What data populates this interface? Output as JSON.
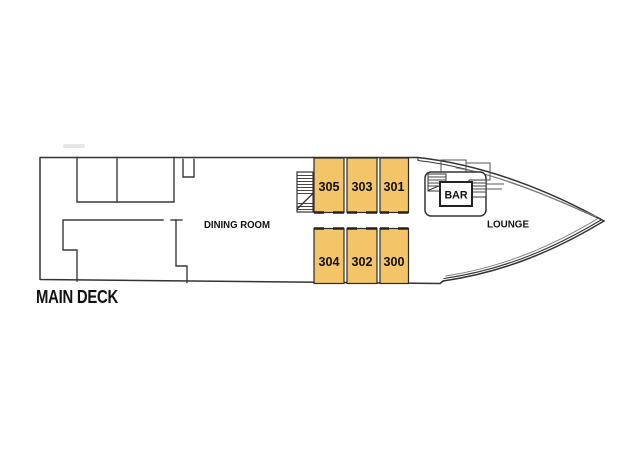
{
  "deck": {
    "title": "MAIN DECK"
  },
  "areas": {
    "dining_room": "DINING ROOM",
    "lounge": "LOUNGE",
    "bar": "BAR"
  },
  "cabins": {
    "top_row": [
      "305",
      "303",
      "301"
    ],
    "bottom_row": [
      "304",
      "302",
      "300"
    ]
  },
  "colors": {
    "cabin_fill": "#F3C468",
    "line": "#333333",
    "text": "#111111"
  }
}
